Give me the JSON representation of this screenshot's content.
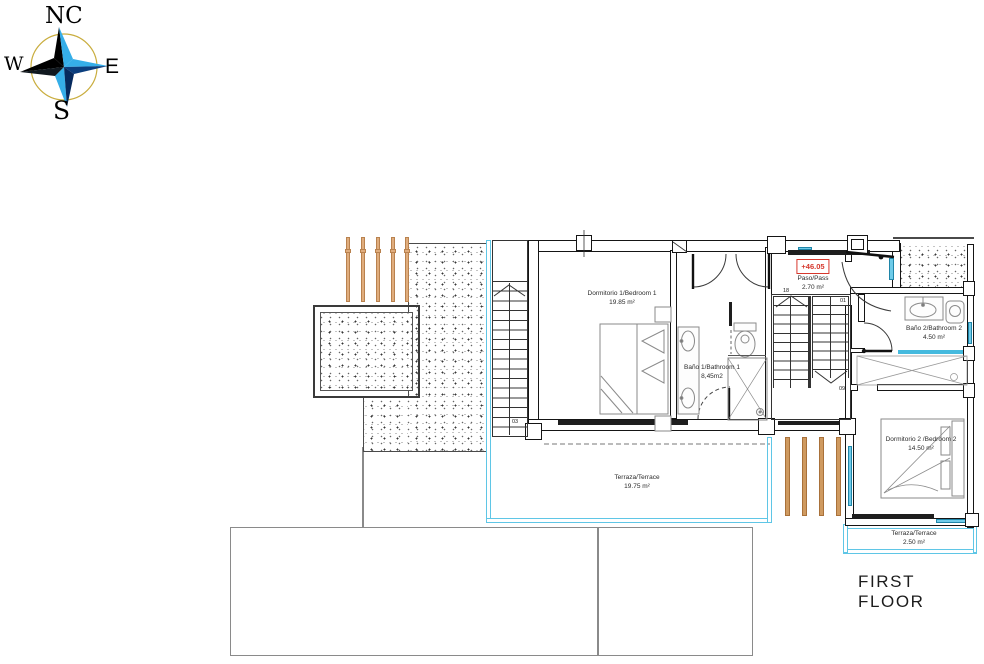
{
  "title": "FIRST FLOOR",
  "compass": {
    "n": "NC",
    "w": "W",
    "e": "E",
    "s": "S"
  },
  "paso_level": "+46.05",
  "rooms": {
    "bedroom1": {
      "name": "Dormitorio 1/Bedroom 1",
      "area": "19.85 m²"
    },
    "bathroom1": {
      "name": "Baño 1/Bathroom 1",
      "area": "8,45m2"
    },
    "paso": {
      "name": "Paso/Pass",
      "area": "2.70 m²"
    },
    "bathroom2": {
      "name": "Baño 2/Bathroom 2",
      "area": "4.50 m²"
    },
    "bedroom2": {
      "name": "Dormitorio 2 /Bedroom 2",
      "area": "14.50 m²"
    },
    "terrace_main": {
      "name": "Terraza/Terrace",
      "area": "19.75 m²"
    },
    "terrace_small": {
      "name": "Terraza/Terrace",
      "area": "2.50 m²"
    }
  },
  "stairs": {
    "interior_top": "18",
    "interior_first": "01",
    "interior_last": "09",
    "exterior_bottom": "03"
  },
  "colors": {
    "wall": "#151515",
    "glass_cyan": "#5fc6e6",
    "wood_tan": "#d9a76b",
    "level_red": "#d6372c",
    "compass_ring": "#c9ad3e",
    "compass_light_blue": "#35aee8",
    "compass_dark_blue": "#0b3e7e"
  }
}
